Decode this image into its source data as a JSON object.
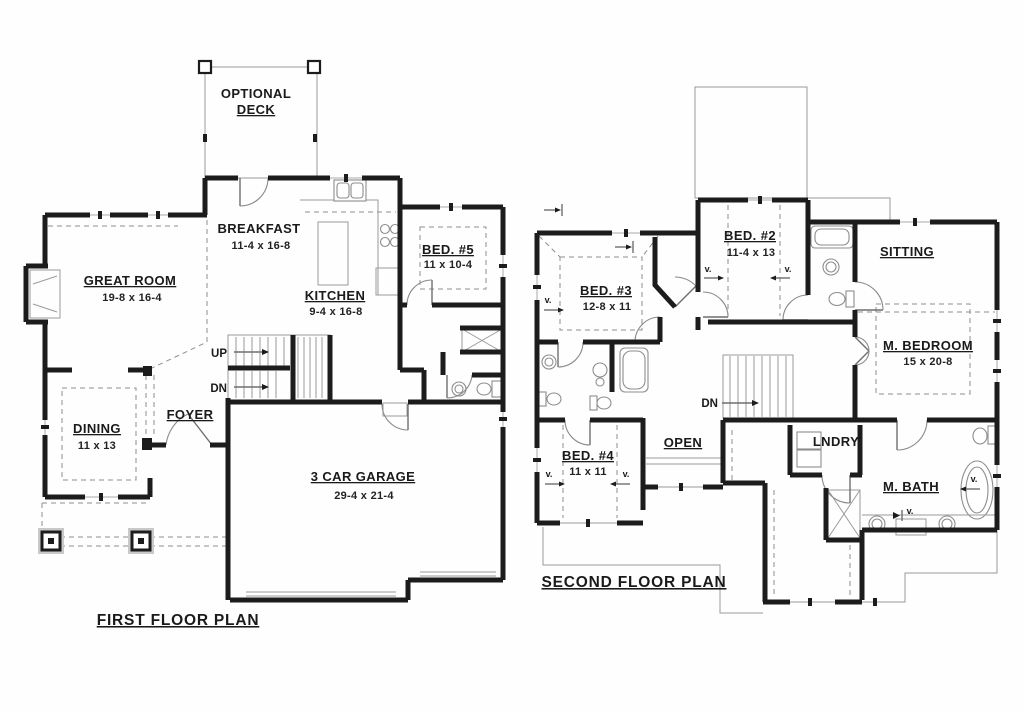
{
  "image_type": "architectural floor plan drawing, black line work on white",
  "colors": {
    "walls": "#1c1c1c",
    "thin_lines": "#9b9b9b",
    "dashed_lines": "#8f8f8f",
    "text": "#1a1a1a",
    "background": "#ffffff"
  },
  "first_floor": {
    "plan_label": "FIRST FLOOR PLAN",
    "deck_line1": "OPTIONAL",
    "deck_line2": "DECK",
    "breakfast_name": "BREAKFAST",
    "breakfast_dims": "11-4 x 16-8",
    "great_room_name": "GREAT ROOM",
    "great_room_dims": "19-8 x 16-4",
    "kitchen_name": "KITCHEN",
    "kitchen_dims": "9-4 x 16-8",
    "bed5_name": "BED. #5",
    "bed5_dims": "11 x 10-4",
    "dining_name": "DINING",
    "dining_dims": "11 x 13",
    "foyer_name": "FOYER",
    "garage_name": "3 CAR GARAGE",
    "garage_dims": "29-4 x 21-4",
    "stair_up": "UP",
    "stair_down": "DN"
  },
  "second_floor": {
    "plan_label": "SECOND FLOOR PLAN",
    "bed2_name": "BED. #2",
    "bed2_dims": "11-4 x 13",
    "bed3_name": "BED. #3",
    "bed3_dims": "12-8 x 11",
    "bed4_name": "BED. #4",
    "bed4_dims": "11 x 11",
    "sitting_name": "SITTING",
    "m_bedroom_name": "M. BEDROOM",
    "m_bedroom_dims": "15 x 20-8",
    "m_bath_name": "M. BATH",
    "open_name": "OPEN",
    "laundry_name": "LNDRY",
    "stair_down": "DN",
    "vault_marker": "v."
  }
}
